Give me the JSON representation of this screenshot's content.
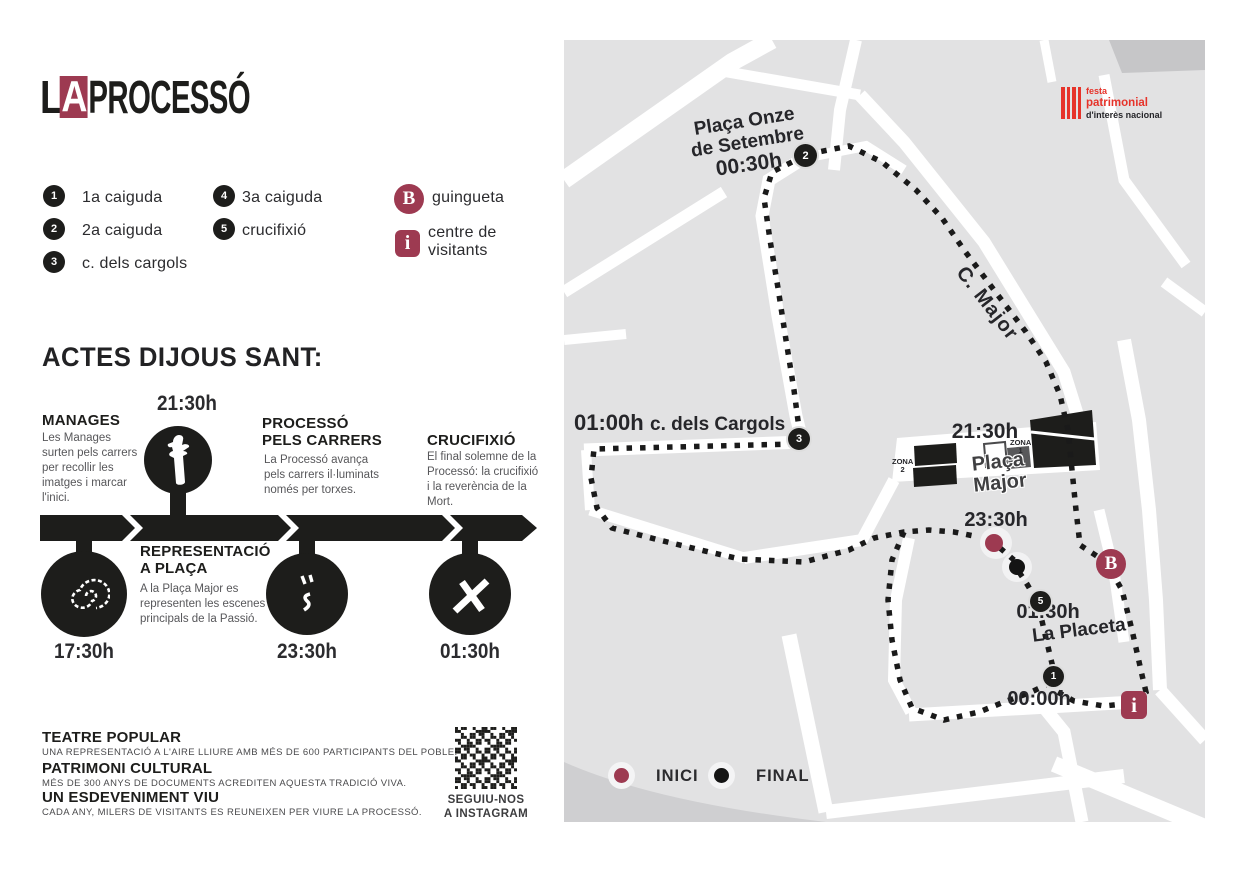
{
  "colors": {
    "maroon": "#9d3a51",
    "black": "#1d1d1b",
    "map_bg": "#e2e2e3",
    "street": "#ffffff",
    "accent_red": "#e6332a",
    "text_gray": "#57575a"
  },
  "logo": {
    "l": "L",
    "a": "A",
    "rest": "PROCESSÓ"
  },
  "legend": {
    "items": [
      {
        "n": "1",
        "label": "1a caiguda"
      },
      {
        "n": "2",
        "label": "2a caiguda"
      },
      {
        "n": "3",
        "label": "c. dels cargols"
      },
      {
        "n": "4",
        "label": "3a caiguda"
      },
      {
        "n": "5",
        "label": "crucifixió"
      }
    ],
    "guingueta": {
      "badge": "B",
      "label": "guingueta"
    },
    "visitants": {
      "badge": "i",
      "line1": "centre de",
      "line2": "visitants"
    }
  },
  "heading": "ACTES DIJOUS SANT:",
  "timeline": {
    "manages": {
      "time": "21:30h",
      "title": "MANAGES",
      "desc": "Les Manages surten pels carrers per recollir les imatges i marcar l'inici."
    },
    "carrers": {
      "title1": "PROCESSÓ",
      "title2": "PELS CARRERS",
      "desc": "La Processó avança pels carrers il·luminats només per torxes."
    },
    "crucifixio": {
      "title": "CRUCIFIXIÓ",
      "desc": "El final solemne de la Processó: la crucifixió i la reverència de la Mort."
    },
    "representacio": {
      "title1": "REPRESENTACIÓ",
      "title2": "A PLAÇA",
      "desc": "A la Plaça Major es representen les escenes principals de la Passió."
    },
    "time_1730": "17:30h",
    "time_2330": "23:30h",
    "time_0130": "01:30h"
  },
  "footer": {
    "items": [
      {
        "title": "TEATRE POPULAR",
        "desc": "UNA REPRESENTACIÓ A L'AIRE LLIURE AMB MÉS DE 600 PARTICIPANTS DEL POBLE."
      },
      {
        "title": "PATRIMONI CULTURAL",
        "desc": "MÉS DE 300 ANYS DE DOCUMENTS ACREDITEN AQUESTA TRADICIÓ VIVA."
      },
      {
        "title": "UN ESDEVENIMENT VIU",
        "desc": "CADA ANY, MILERS DE VISITANTS ES REUNEIXEN PER VIURE LA PROCESSÓ."
      }
    ],
    "instagram1": "SEGUIU-NOS",
    "instagram2": "A INSTAGRAM"
  },
  "map": {
    "placa_onze1": "Plaça Onze",
    "placa_onze2": "de Setembre",
    "time_0030": "00:30h",
    "c_major": "C. Major",
    "time_0100": "01:00h",
    "cargols": "c. dels Cargols",
    "time_2130": "21:30h",
    "placa_major1": "Plaça",
    "placa_major2": "Major",
    "zona1a": "ZONA",
    "zona1b": "1",
    "zona2a": "ZONA",
    "zona2b": "2",
    "time_2330": "23:30h",
    "time_0130": "01:30h",
    "la_placeta": "La Placeta",
    "time_0000": "00:00h",
    "badge_b": "B",
    "badge_i": "i",
    "markers": {
      "m1": "1",
      "m2": "2",
      "m3": "3",
      "m5": "5"
    },
    "legend": {
      "inici": "INICI",
      "final": "FINAL"
    },
    "festa": {
      "line1": "festa",
      "line2": "patrimonial",
      "line3": "d'interès nacional"
    }
  }
}
